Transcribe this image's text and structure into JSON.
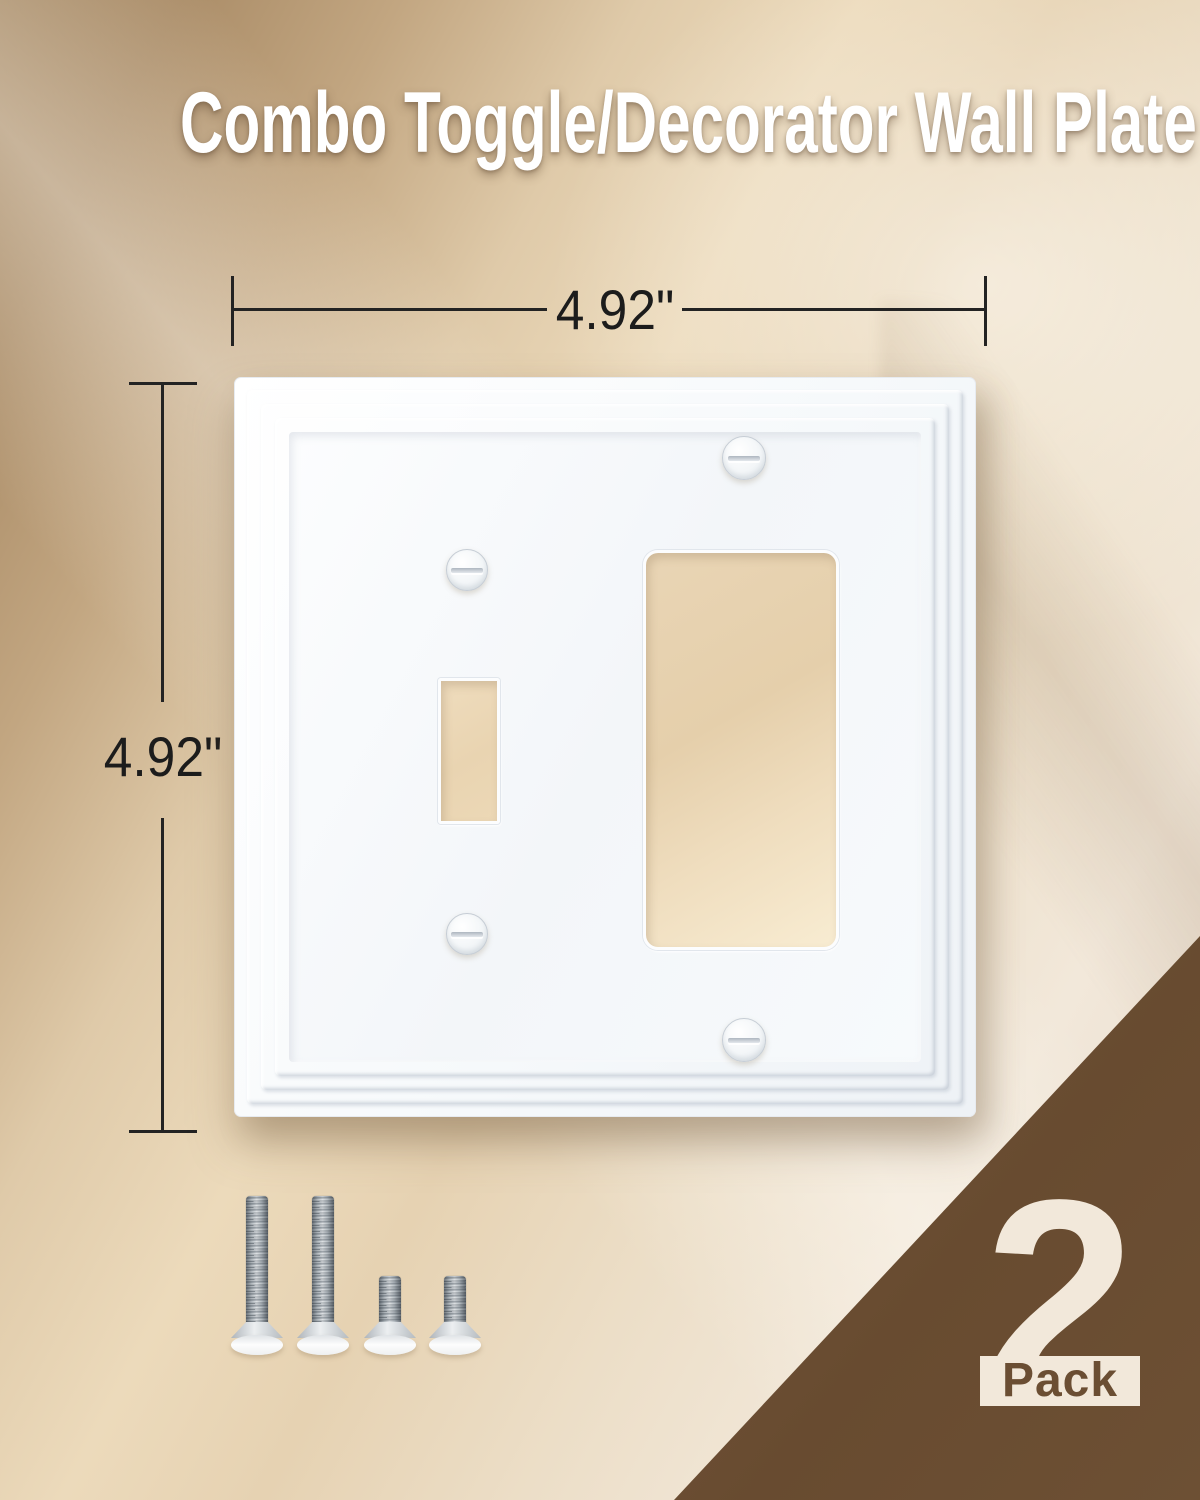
{
  "title": "Combo Toggle/Decorator Wall Plate",
  "dimensions": {
    "width": "4.92\"",
    "height": "4.92\""
  },
  "pack_badge": {
    "count": "2",
    "label": "Pack"
  },
  "plate": {
    "style": "white combo toggle/decorator wall plate with stepped architectural molding frame",
    "openings": [
      {
        "name": "toggle-opening"
      },
      {
        "name": "decorator-opening"
      }
    ],
    "screws": [
      {
        "name": "plate-screw-top"
      },
      {
        "name": "plate-screw-left-upper"
      },
      {
        "name": "plate-screw-left-lower"
      },
      {
        "name": "plate-screw-bottom"
      }
    ]
  },
  "hardware": {
    "screws": [
      {
        "name": "mounting-screw-long"
      },
      {
        "name": "mounting-screw-long"
      },
      {
        "name": "mounting-screw-short"
      },
      {
        "name": "mounting-screw-short"
      }
    ]
  },
  "colors": {
    "background_top_left_tan": "#a1825b",
    "background_light_beige": "#f0e5d6",
    "wall_behind_openings": "#e8d3b2",
    "plate_white": "#ffffff",
    "badge_triangle_brown": "#6b4e33",
    "badge_cream": "#f2e8da",
    "dimension_line_black": "#232323",
    "title_white": "#ffffff"
  }
}
